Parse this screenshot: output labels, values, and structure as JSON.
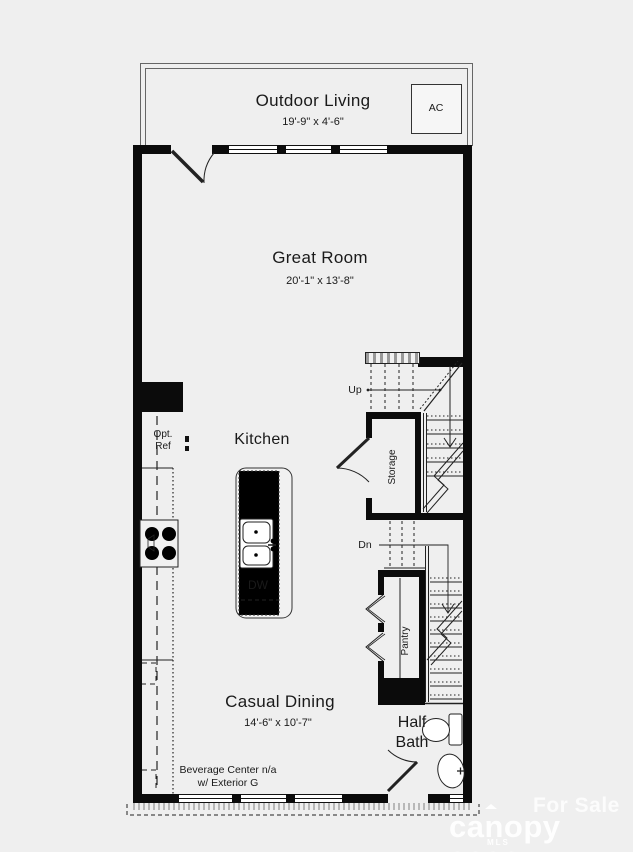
{
  "rooms": {
    "outdoor_living": {
      "label": "Outdoor Living",
      "dims": "19'-9\" x 4'-6\""
    },
    "great_room": {
      "label": "Great Room",
      "dims": "20'-1\" x 13'-8\""
    },
    "kitchen": {
      "label": "Kitchen"
    },
    "casual_dining": {
      "label": "Casual Dining",
      "dims": "14'-6\" x 10'-7\""
    },
    "storage": {
      "label": "Storage"
    },
    "pantry": {
      "label": "Pantry"
    },
    "half_bath": {
      "line1": "Half",
      "line2": "Bath"
    }
  },
  "fixtures": {
    "ac_unit": "AC",
    "opt_ref_line1": "Opt.",
    "opt_ref_line2": "Ref",
    "dishwasher": "DW",
    "stairs_up": "Up",
    "stairs_down": "Dn",
    "beverage_line1": "Beverage Center n/a",
    "beverage_line2": "w/ Exterior G"
  },
  "watermark": {
    "status": "For Sale",
    "brand": "canopy",
    "year": "2026",
    "brand_sub": "MLS"
  },
  "colors": {
    "background": "#efefef",
    "wall": "#0b0b0b",
    "line": "#222222",
    "window_fill": "#ffffff",
    "text": "#1a1a1a",
    "watermark": "#f9f9f9"
  }
}
